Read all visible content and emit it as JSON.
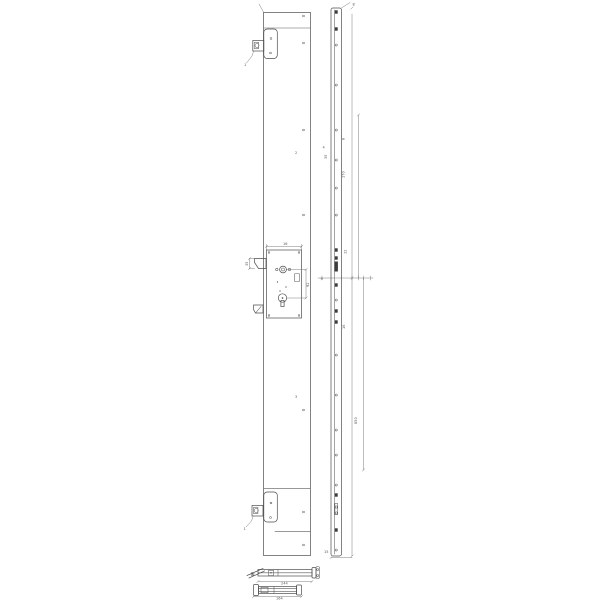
{
  "drawing": {
    "background": "#ffffff",
    "line_color": "#4d4d4d",
    "fill_color": "#3c3c3c",
    "label_color": "#555555"
  },
  "labels": [
    {
      "x": 352.5,
      "y": 5.5,
      "rot": 0,
      "text": "8"
    },
    {
      "x": 344.5,
      "y": 140,
      "rot": -90,
      "text": "8"
    },
    {
      "x": 327,
      "y": 159,
      "rot": -90,
      "text": "35"
    },
    {
      "x": 344.5,
      "y": 178,
      "rot": -90,
      "text": "170"
    },
    {
      "x": 346.5,
      "y": 254,
      "rot": -90,
      "text": "12"
    },
    {
      "x": 320.5,
      "y": 280,
      "rot": 0,
      "text": "9"
    },
    {
      "x": 345,
      "y": 329,
      "rot": -90,
      "text": "16"
    },
    {
      "x": 357,
      "y": 424,
      "rot": -90,
      "text": "850"
    },
    {
      "x": 324,
      "y": 553,
      "rot": 0,
      "text": "15"
    },
    {
      "x": 283,
      "y": 245,
      "rot": 0,
      "text": "16"
    },
    {
      "x": 309,
      "y": 287,
      "rot": -90,
      "text": "92"
    },
    {
      "x": 248,
      "y": 266,
      "rot": -90,
      "text": "35"
    },
    {
      "x": 295,
      "y": 154,
      "rot": 0,
      "text": "2",
      "size": 4.5
    },
    {
      "x": 295,
      "y": 398,
      "rot": 0,
      "text": "3",
      "size": 4.5
    },
    {
      "x": 322.5,
      "y": 148.5,
      "rot": 0,
      "text": "4"
    },
    {
      "x": 244,
      "y": 66,
      "rot": 0,
      "text": "1",
      "size": 4
    },
    {
      "x": 243.5,
      "y": 530,
      "rot": 0,
      "text": "1",
      "size": 4
    },
    {
      "x": 281,
      "y": 584.5,
      "rot": 0,
      "text": "244"
    },
    {
      "x": 276,
      "y": 599.5,
      "rot": 0,
      "text": "164"
    }
  ]
}
